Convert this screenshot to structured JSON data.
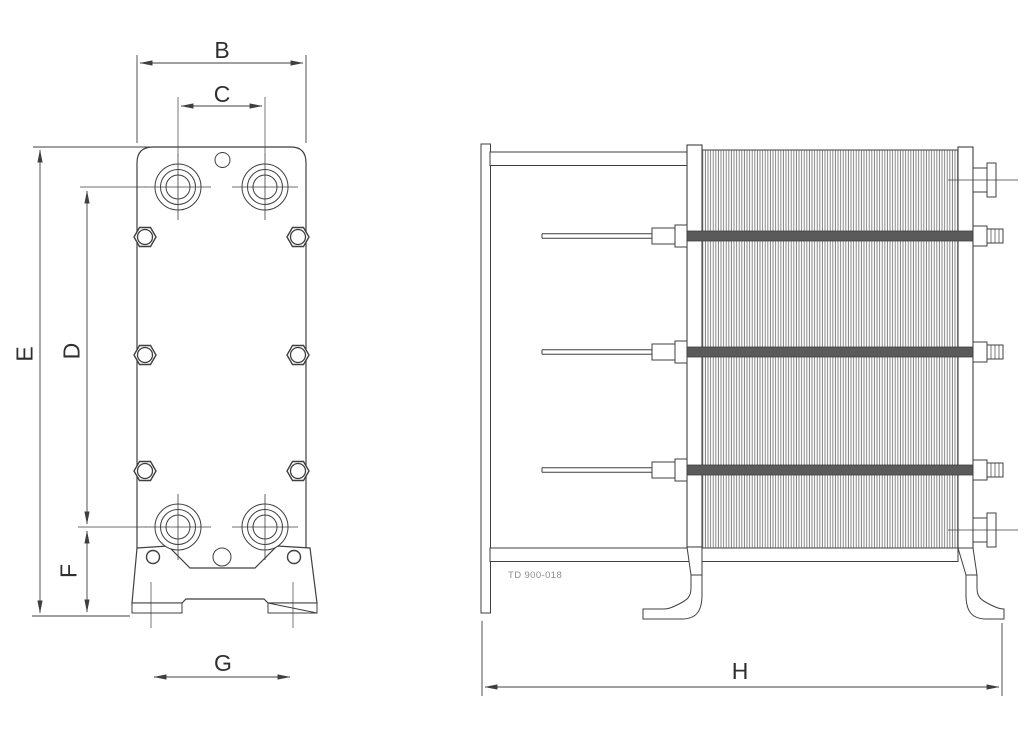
{
  "front_view": {
    "dimensions": {
      "B": "B",
      "C": "C",
      "D": "D",
      "E": "E",
      "F": "F",
      "G": "G"
    }
  },
  "side_view": {
    "dimensions": {
      "H": "H"
    },
    "drawing_number": "TD 900-018"
  },
  "colors": {
    "line": "#3f3f3f",
    "plate_hatch": "#7a7a7a",
    "label_text": "#2f2f2f",
    "note_text": "#8c8c8c",
    "background": "#ffffff"
  }
}
